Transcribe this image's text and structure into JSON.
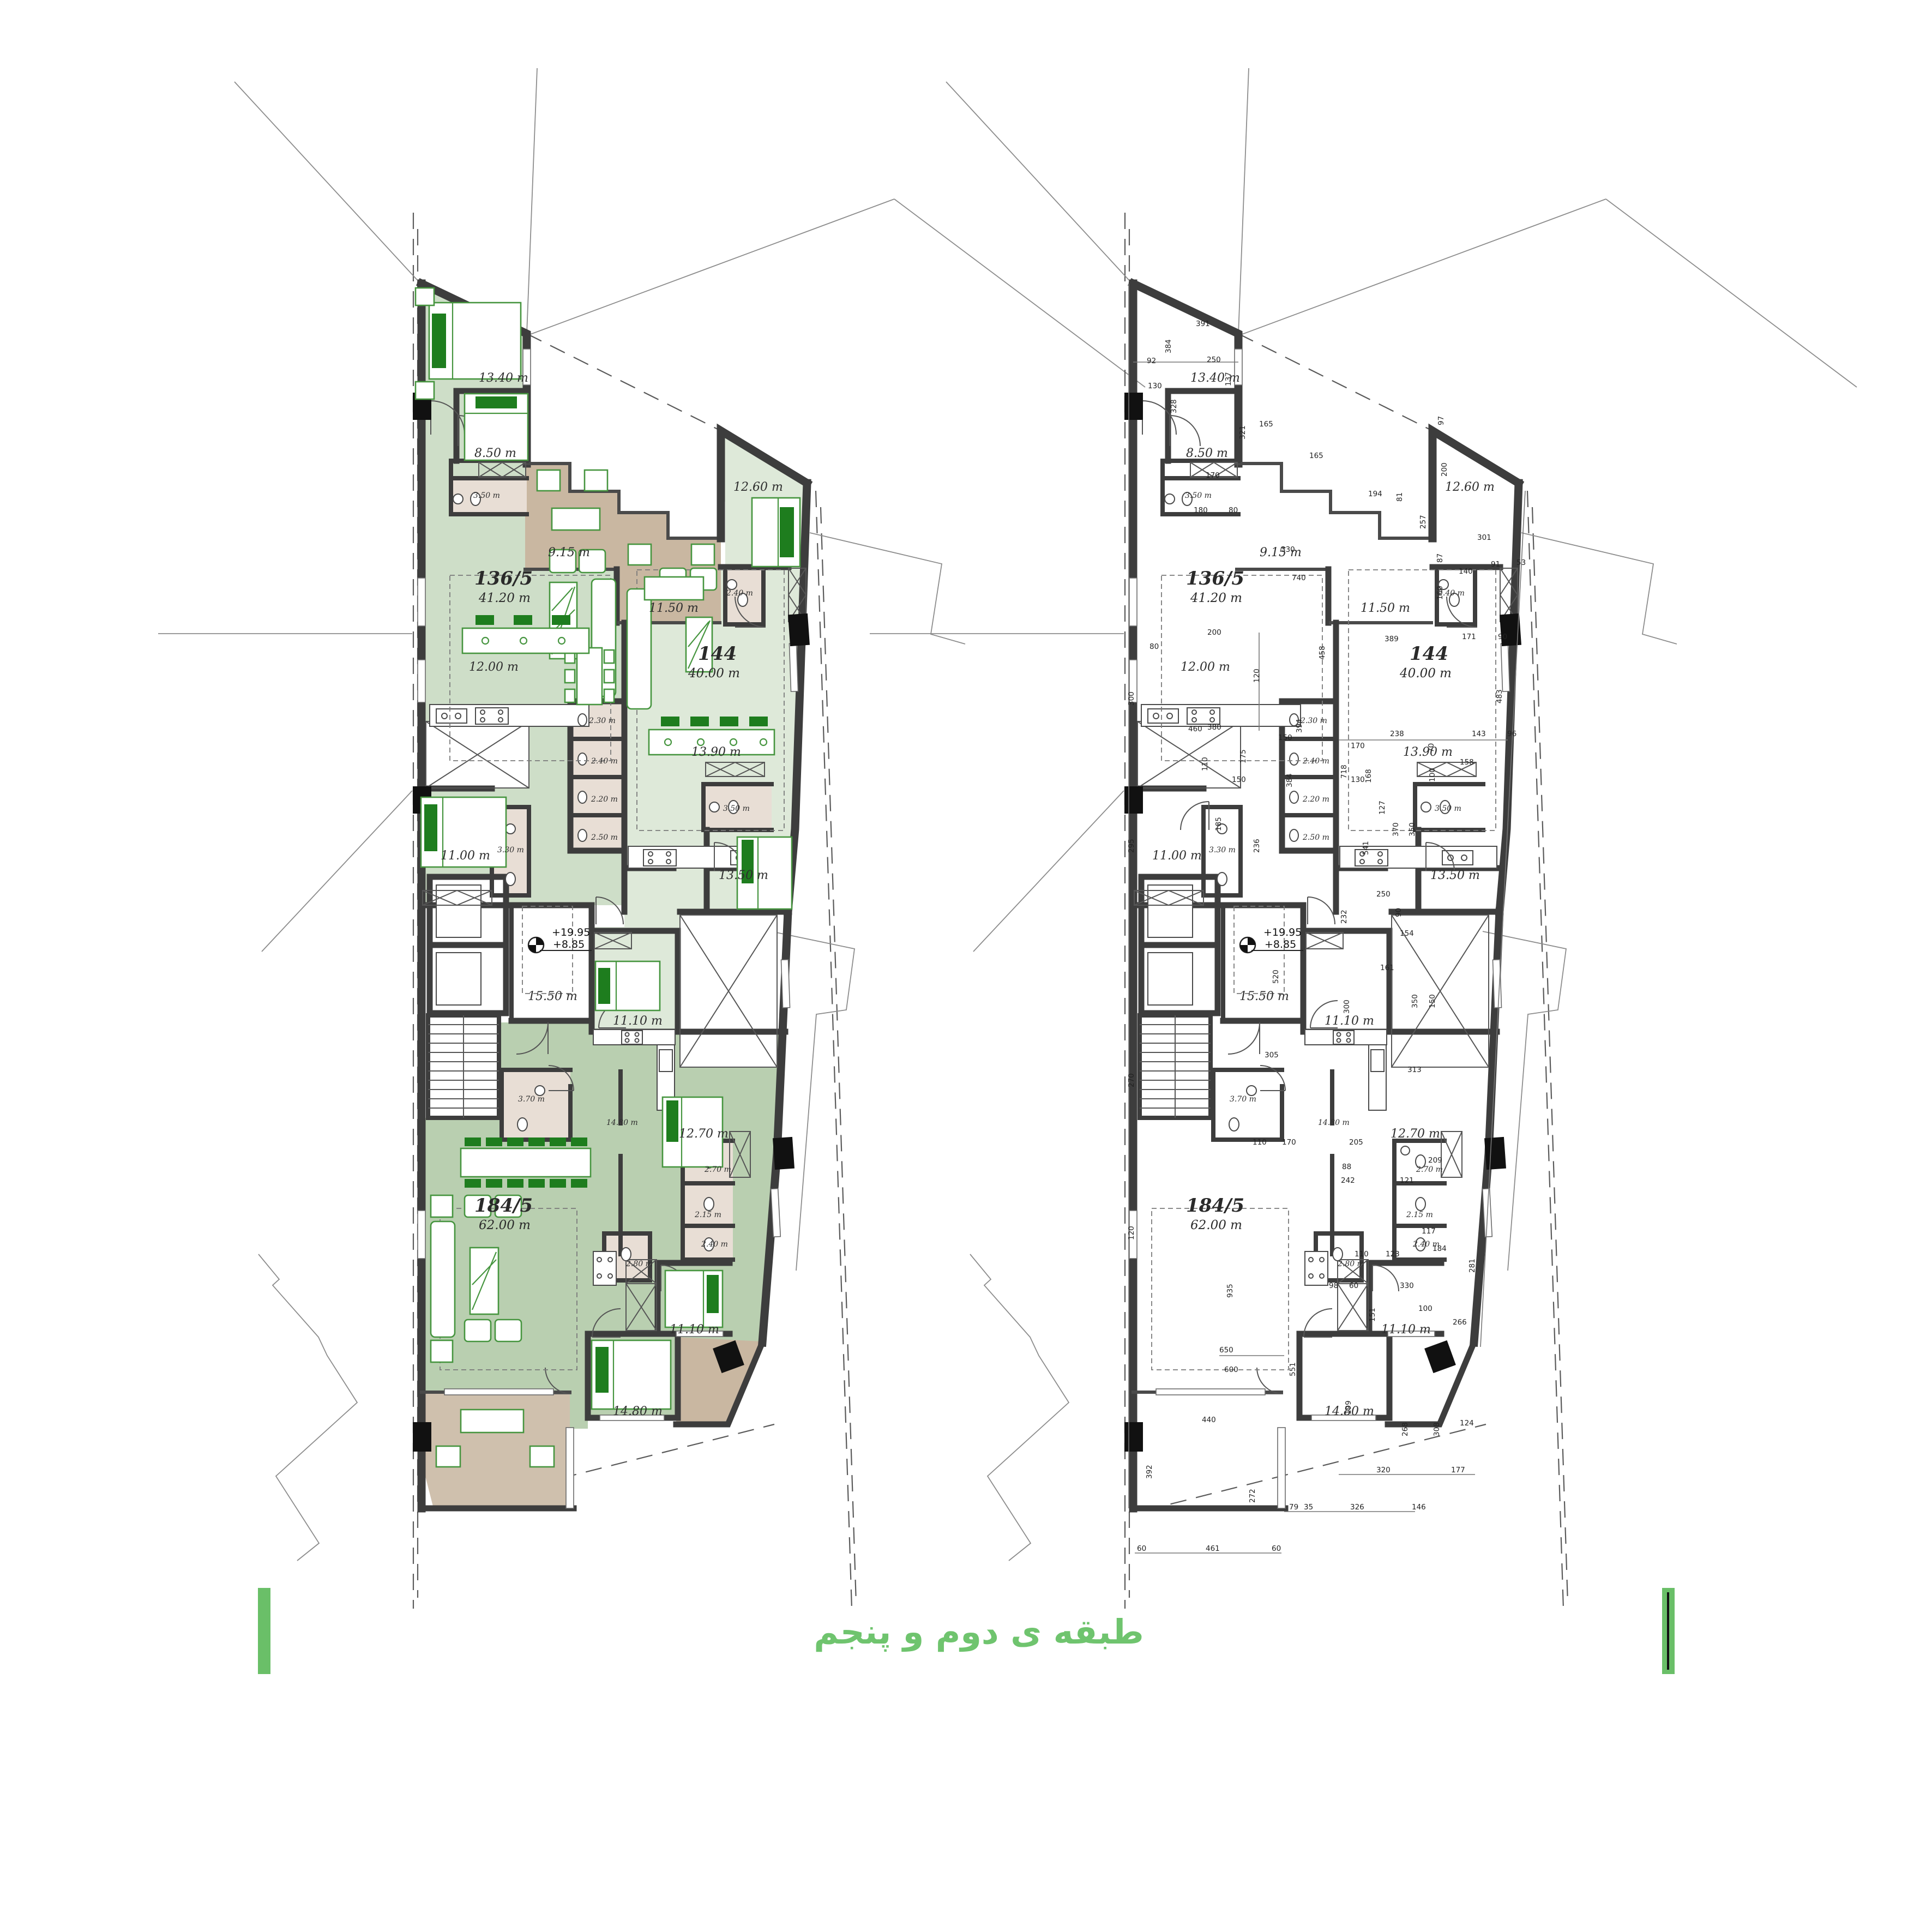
{
  "title": {
    "text": "طبقه ی دوم و پنجم"
  },
  "levels": {
    "upper": "+19.95",
    "lower": "+8.85"
  },
  "units": [
    {
      "number": "136/5",
      "area": "41.20 m"
    },
    {
      "number": "144",
      "area": "40.00 m"
    },
    {
      "number": "184/5",
      "area": "62.00 m"
    }
  ],
  "rooms": [
    {
      "id": "bedroom-nw",
      "label": "13.40 m"
    },
    {
      "id": "bedroom-2",
      "label": "8.50 m"
    },
    {
      "id": "bath-ensuite",
      "label": "3.50 m"
    },
    {
      "id": "terrace-1",
      "label": "9.15 m"
    },
    {
      "id": "terrace-2",
      "label": "11.50 m"
    },
    {
      "id": "bedroom-ne",
      "label": "12.60 m"
    },
    {
      "id": "bath-ne",
      "label": "2.40 m"
    },
    {
      "id": "kitchen-136",
      "label": "12.00 m"
    },
    {
      "id": "kitchen-144",
      "label": "13.90 m"
    },
    {
      "id": "wc-a",
      "label": "2.30 m"
    },
    {
      "id": "wc-b",
      "label": "2.40 m"
    },
    {
      "id": "wc-c",
      "label": "2.20 m"
    },
    {
      "id": "wc-d",
      "label": "2.50 m"
    },
    {
      "id": "bedroom-w",
      "label": "11.00 m"
    },
    {
      "id": "bath-w",
      "label": "3.30 m"
    },
    {
      "id": "bath-144",
      "label": "3.50 m"
    },
    {
      "id": "bedroom-e",
      "label": "13.50 m"
    },
    {
      "id": "lobby",
      "label": "15.50 m"
    },
    {
      "id": "bedroom-center",
      "label": "11.10 m"
    },
    {
      "id": "bath-south",
      "label": "3.70 m"
    },
    {
      "id": "kitchen-184",
      "label": "14.80 m"
    },
    {
      "id": "bedroom-se",
      "label": "12.70 m"
    },
    {
      "id": "bath-s1",
      "label": "2.70 m"
    },
    {
      "id": "bath-s2",
      "label": "2.15 m"
    },
    {
      "id": "bath-s3",
      "label": "2.40 m"
    },
    {
      "id": "bath-s4",
      "label": "2.80 m"
    },
    {
      "id": "bedroom-s1",
      "label": "11.10 m"
    },
    {
      "id": "bedroom-s2",
      "label": "14.80 m"
    }
  ],
  "dims": [
    "391",
    "384",
    "92",
    "130",
    "250",
    "328",
    "137",
    "165",
    "165",
    "170",
    "180",
    "80",
    "321",
    "330",
    "740",
    "97",
    "200",
    "301",
    "87",
    "140",
    "160",
    "91",
    "53",
    "171",
    "90",
    "389",
    "194",
    "81",
    "257",
    "458",
    "718",
    "200",
    "80",
    "120",
    "380",
    "150",
    "175",
    "541",
    "483",
    "238",
    "143",
    "96",
    "70",
    "168",
    "460",
    "300",
    "295",
    "110",
    "150",
    "185",
    "236",
    "384",
    "394",
    "170",
    "130",
    "127",
    "370",
    "350",
    "100",
    "158",
    "520",
    "305",
    "250",
    "232",
    "161",
    "154",
    "300",
    "350",
    "150",
    "313",
    "90",
    "270",
    "120",
    "110",
    "170",
    "205",
    "88",
    "98",
    "60",
    "330",
    "281",
    "242",
    "121",
    "209",
    "117",
    "184",
    "100",
    "266",
    "110",
    "123",
    "151",
    "199",
    "935",
    "551",
    "650",
    "600",
    "392",
    "272",
    "79",
    "35",
    "326",
    "146",
    "60",
    "461",
    "60",
    "440",
    "320",
    "177",
    "124",
    "308",
    "268"
  ],
  "colors": {
    "title_green": "#6fc46e",
    "bar_green": "#6abf68",
    "wall": "#3d3d3d",
    "unit_136_5": "#cedec8",
    "unit_144": "#dee9d9",
    "unit_184_5": "#b9cfb0",
    "terrace_tan": "#c9b7a1",
    "bath_beige": "#e8ded5",
    "furniture_green": "#46953f"
  }
}
